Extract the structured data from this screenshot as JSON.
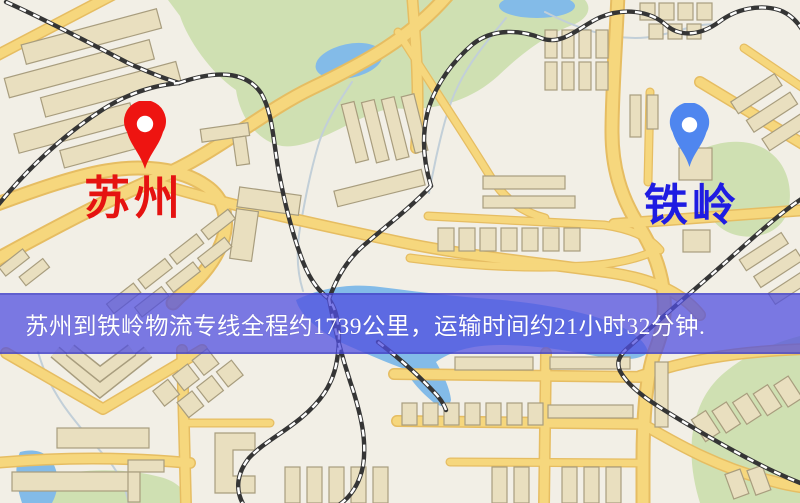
{
  "map": {
    "type": "road-map",
    "colors": {
      "background": "#f2efe6",
      "road": "#f6d77d",
      "road_casing": "#e6bd62",
      "building": "#e9dfbf",
      "building_outline": "#a89d7e",
      "park": "#cfe0b2",
      "water": "#83bbe8",
      "railway": "#353535",
      "stream": "#c2cfd8"
    }
  },
  "markers": {
    "origin": {
      "label": "苏州",
      "pin_color": "#ee1411",
      "label_color": "#e51311"
    },
    "destination": {
      "label": "铁岭",
      "pin_color": "#4f86ef",
      "label_color": "#1f1ce2"
    }
  },
  "banner": {
    "text": "苏州到铁岭物流专线全程约1739公里，运输时间约21小时32分钟.",
    "background": "#504ee0",
    "opacity": 0.74,
    "text_color": "#ffffff",
    "route": {
      "origin": "苏州",
      "destination": "铁岭",
      "distance": "约1739公里",
      "duration": "约21小时32分钟"
    }
  }
}
